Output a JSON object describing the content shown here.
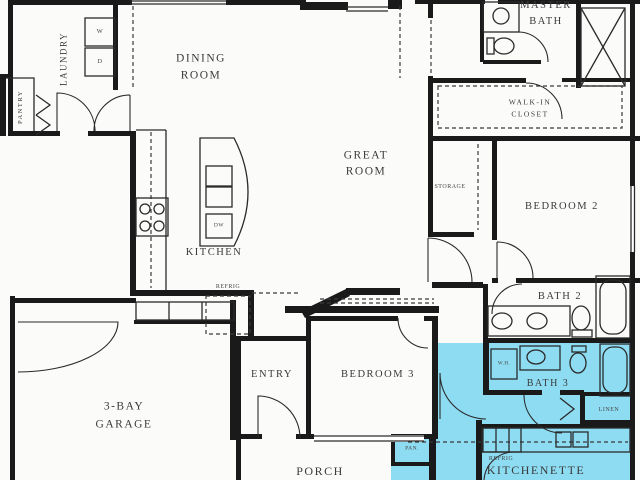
{
  "plan": {
    "type": "residential floor plan",
    "highlight_color": "#8edcf2",
    "wall_color": "#1a1a1a",
    "rooms": {
      "pantry": "PANTRY",
      "laundry": "LAUNDRY",
      "dining_line1": "DINING",
      "dining_line2": "ROOM",
      "master_bath_line1": "MASTER",
      "master_bath_line2": "BATH",
      "walk_in_closet_line1": "WALK-IN",
      "walk_in_closet_line2": "CLOSET",
      "great_room_line1": "GREAT",
      "great_room_line2": "ROOM",
      "storage": "STORAGE",
      "bedroom2": "BEDROOM 2",
      "kitchen": "KITCHEN",
      "bath2": "BATH 2",
      "entry": "ENTRY",
      "bedroom3": "BEDROOM 3",
      "garage_line1": "3-BAY",
      "garage_line2": "GARAGE",
      "porch": "PORCH",
      "bath3": "BATH 3",
      "linen": "LINEN",
      "kitchenette": "KITCHENETTE"
    },
    "appliances": {
      "washer": "W",
      "dryer": "D",
      "dishwasher": "DW",
      "refrigerator": "REFRIG",
      "kitchenette_refrigerator": "REFRIG",
      "water_heater": "W.H.",
      "pantry_cabinet": "PAN."
    }
  }
}
